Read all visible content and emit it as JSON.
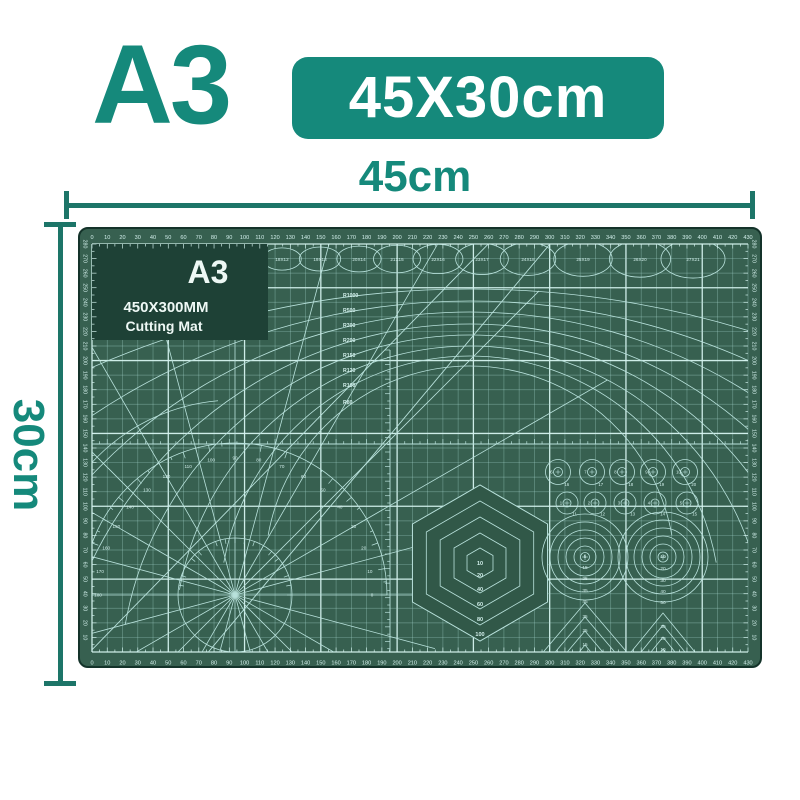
{
  "page": {
    "background": "#ffffff"
  },
  "header": {
    "size_code": "A3",
    "badge_label": "45X30cm",
    "accent_color": "#15897b"
  },
  "dimension_annotations": {
    "width_label": "45cm",
    "height_label": "30cm",
    "line_color": "#1d7568"
  },
  "mat": {
    "colors": {
      "body": "#376050",
      "hex_fill": "#315848",
      "edge": "#14332a",
      "logo_block": "#1e4136",
      "grid_minor": "rgba(165,212,205,0.45)",
      "grid_major": "rgba(214,244,240,0.95)",
      "decor": "#b9e2dc",
      "text": "#d2efeb",
      "logo_text": "#eef8f5"
    },
    "logo": {
      "title": "A3",
      "line1": "450X300MM",
      "line2": "Cutting Mat"
    },
    "rulers": {
      "horizontal": {
        "start": 0,
        "end": 430,
        "step": 10
      },
      "vertical": {
        "start": 280,
        "end": 10,
        "step": -10
      }
    },
    "ellipse_row": [
      "15X9",
      "16X10",
      "17X11",
      "18X12",
      "19X13",
      "20X14",
      "21X15",
      "22X16",
      "23X17",
      "24X18",
      "25X19",
      "26X20",
      "27X21"
    ],
    "radius_arcs": [
      "R1000",
      "R500",
      "R300",
      "R200",
      "R150",
      "R120",
      "R100",
      "R80"
    ],
    "protractor_degrees": [
      0,
      10,
      20,
      30,
      40,
      50,
      60,
      70,
      80,
      90,
      100,
      110,
      120,
      130,
      140,
      150,
      160,
      170,
      180
    ],
    "hexagons": {
      "center_label": "10",
      "ring_labels": [
        "20",
        "40",
        "60",
        "80",
        "100"
      ]
    },
    "circle_grid": {
      "row1": {
        "inner": [
          "6",
          "7",
          "8",
          "9",
          "10"
        ],
        "outer": [
          "16",
          "17",
          "18",
          "19",
          "20"
        ]
      },
      "row2": {
        "inner": [
          "1",
          "2",
          "3",
          "4",
          "5"
        ],
        "outer": [
          "11",
          "12",
          "13",
          "14",
          "15"
        ]
      }
    },
    "targets": [
      {
        "labels": [
          "5",
          "15",
          "25",
          "35",
          "45"
        ]
      },
      {
        "labels": [
          "10",
          "20",
          "30",
          "40",
          "50"
        ]
      }
    ],
    "triangles": [
      {
        "labels": [
          "35",
          "25",
          "15"
        ]
      },
      {
        "labels": [
          "30",
          "20",
          "10"
        ]
      }
    ]
  }
}
